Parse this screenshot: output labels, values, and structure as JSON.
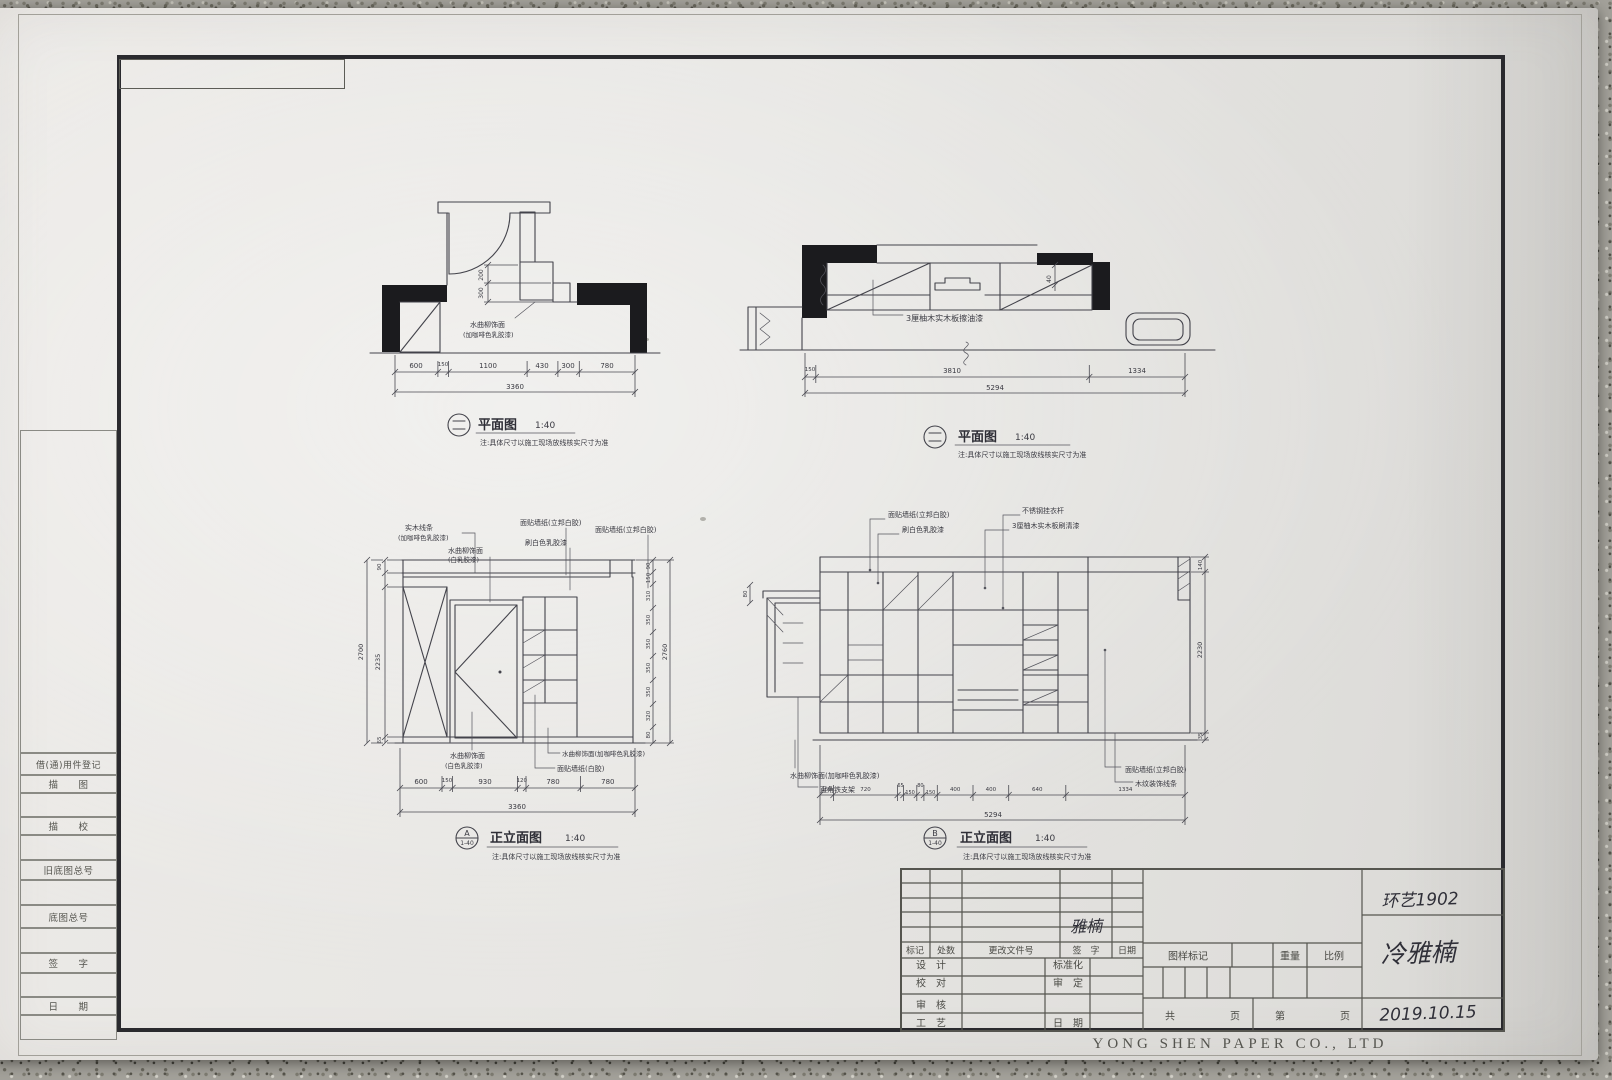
{
  "sheet": {
    "company_footer": "YONG SHEN PAPER CO., LTD",
    "handwritten_class": "环艺1902",
    "handwritten_name": "冷雅楠",
    "handwritten_date": "2019.10.15",
    "handwritten_signature": "雅楠"
  },
  "side_column": {
    "register_label": "借(通)用件登记",
    "trace_label": "描　　图",
    "trace_check_label": "描　　校",
    "old_negative_label": "旧底图总号",
    "negative_label": "底图总号",
    "sign_label": "签　　字",
    "date_label": "日　　期"
  },
  "title_block": {
    "rev_header": [
      "标记",
      "处数",
      "更改文件号",
      "签　字",
      "日期"
    ],
    "role_design": "设　计",
    "role_check": "校　对",
    "role_review": "审　核",
    "role_craft": "工　艺",
    "role_standard": "标准化",
    "role_approve": "审　定",
    "role_date": "日　期",
    "sample_mark": "图样标记",
    "weight": "重量",
    "scale": "比例",
    "pages_total": "共",
    "pages_unit1": "页",
    "pages_no": "第",
    "pages_unit2": "页"
  },
  "drawings": {
    "plan1": {
      "title": "平面图",
      "scale": "1:40",
      "note": "注:具体尺寸以施工现场放线核实尺寸为准",
      "annotation_l1": "水曲柳饰面",
      "annotation_l2": "(加咖啡色乳胶漆)",
      "dims": [
        "600",
        "150",
        "1100",
        "430",
        "300",
        "780"
      ],
      "total": "3360",
      "side_dims": [
        "200",
        "300"
      ]
    },
    "plan2": {
      "title": "平面图",
      "scale": "1:40",
      "note": "注:具体尺寸以施工现场放线核实尺寸为准",
      "annotation": "3厘柚木实木板擦油漆",
      "dims": [
        "150",
        "3810",
        "1334"
      ],
      "total": "5294",
      "side_dim": "40"
    },
    "elev_a": {
      "symbol_top": "A",
      "symbol_bottom": "1-40",
      "title": "正立面图",
      "scale": "1:40",
      "note": "注:具体尺寸以施工现场放线核实尺寸为准",
      "label_top_1a": "实木线条",
      "label_top_1b": "(加咖啡色乳胶漆)",
      "label_top_2a": "水曲柳饰面",
      "label_top_2b": "(白乳胶漆)",
      "label_top_3": "面贴墙纸(立邦白胶)",
      "label_top_4": "刷白色乳胶漆",
      "label_top_5": "面贴墙纸(立邦白胶)",
      "label_bot_1a": "水曲柳饰面",
      "label_bot_1b": "(白色乳胶漆)",
      "label_bot_2": "水曲柳饰面(加咖啡色乳胶漆)",
      "label_bot_3": "面贴墙纸(白胶)",
      "dims_bottom": [
        "600",
        "150",
        "930",
        "120",
        "780",
        "780"
      ],
      "total_bottom": "3360",
      "dims_left": [
        "90",
        "2235",
        "65"
      ],
      "total_left": "2700",
      "dims_right": [
        "90",
        "150",
        "310",
        "350",
        "350",
        "350",
        "350",
        "320",
        "80"
      ],
      "total_right": "2760"
    },
    "elev_b": {
      "symbol_top": "B",
      "symbol_bottom": "1-40",
      "title": "正立面图",
      "scale": "1:40",
      "note": "注:具体尺寸以施工现场放线核实尺寸为准",
      "label_top_1": "面贴墙纸(立邦白胶)",
      "label_top_2": "刷白色乳胶漆",
      "label_top_3": "不锈钢挂衣杆",
      "label_top_4": "3厘柚木实木板刷清漆",
      "label_bot_1": "水曲柳饰面(加咖啡色乳胶漆)",
      "label_bot_2": "直角铁支架",
      "label_bot_3": "面贴墙纸(立邦白胶)",
      "label_bot_4": "木纹装饰线条",
      "dims_bottom": [
        "150",
        "720",
        "65",
        "150",
        "80",
        "150",
        "400",
        "400",
        "640",
        "1334"
      ],
      "total_bottom": "5294",
      "dims_right": [
        "140",
        "2230",
        "35"
      ],
      "dim_left": "80"
    }
  }
}
